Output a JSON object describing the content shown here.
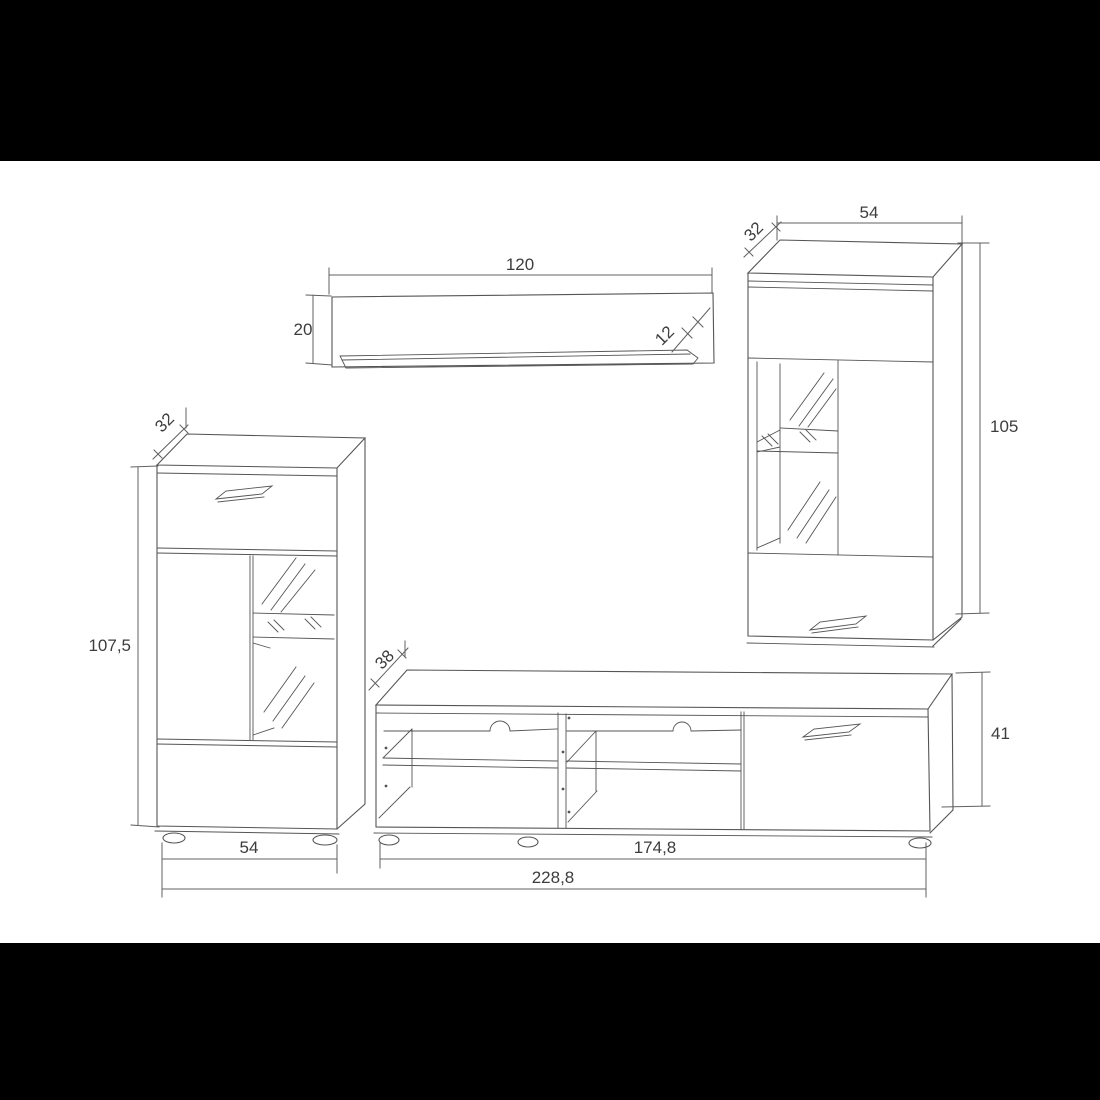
{
  "colors": {
    "background": "#ffffff",
    "letterbox": "#000000",
    "line": "#555555",
    "dimension_line": "#606060",
    "text": "#3d3d3d"
  },
  "labels": {
    "shelf_width": "120",
    "shelf_height": "20",
    "shelf_depth": "12",
    "wall_cabinet_width": "54",
    "wall_cabinet_depth": "32",
    "wall_cabinet_height": "105",
    "cabinet_depth": "32",
    "cabinet_height": "107,5",
    "cabinet_width": "54",
    "tv_stand_depth": "38",
    "tv_stand_height": "41",
    "tv_stand_width": "174,8",
    "total_width": "228,8"
  }
}
